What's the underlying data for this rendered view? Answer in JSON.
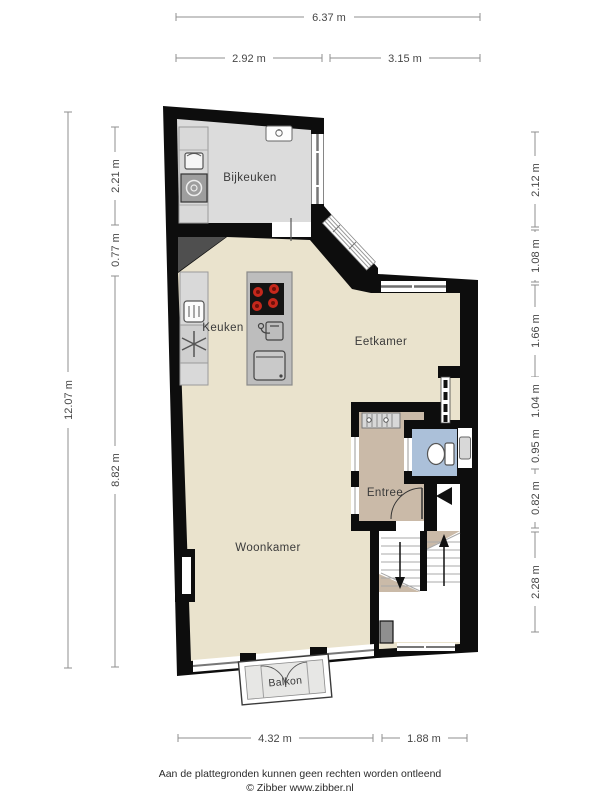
{
  "plan": {
    "type": "floorplan",
    "rooms": {
      "bijkeuken": "Bijkeuken",
      "keuken": "Keuken",
      "eetkamer": "Eetkamer",
      "entree": "Entree",
      "woonkamer": "Woonkamer",
      "balkon": "Balkon"
    },
    "fixtures": [
      "washing-machine",
      "laundry-sink",
      "boiler-sink",
      "oven",
      "freezer-snowflake",
      "cooktop-4-burners",
      "island-sink",
      "dishwasher",
      "radiator",
      "toilet",
      "hand-basin",
      "fireplace",
      "stairs-up",
      "stairs-down",
      "entrance-arrow",
      "balcony-doors"
    ]
  },
  "dimensions": {
    "top_total": "6.37 m",
    "top_segments": [
      "2.92 m",
      "3.15 m"
    ],
    "left_total": "12.07 m",
    "left_segments": [
      "2.21 m",
      "0.77 m",
      "8.82 m"
    ],
    "right_segments": [
      "2.12 m",
      "1.08 m",
      "1.66 m",
      "1.04 m",
      "0.95 m",
      "0.82 m",
      "2.28 m"
    ],
    "bottom_segments": [
      "4.32 m",
      "1.88 m"
    ]
  },
  "footer": {
    "disclaimer": "Aan de plattegronden kunnen geen rechten worden ontleend",
    "copyright": "© Zibber www.zibber.nl"
  },
  "colors": {
    "wall": "#0d0d0d",
    "main_floor": "#eae3cd",
    "utility_floor": "#dcdcdc",
    "entry_floor": "#cabaa8",
    "toilet_floor": "#abc0d9",
    "balcony_floor": "#e7e7e5",
    "counter": "#d9d9d9",
    "island": "#bdbdbd",
    "cooktop": "#141414",
    "burner_red": "#c5281c",
    "diagonal_wall": "#4f4f4f",
    "dimension_line": "#8f8f8f",
    "dimension_text": "#474747",
    "label_text": "#3a3a3a"
  }
}
